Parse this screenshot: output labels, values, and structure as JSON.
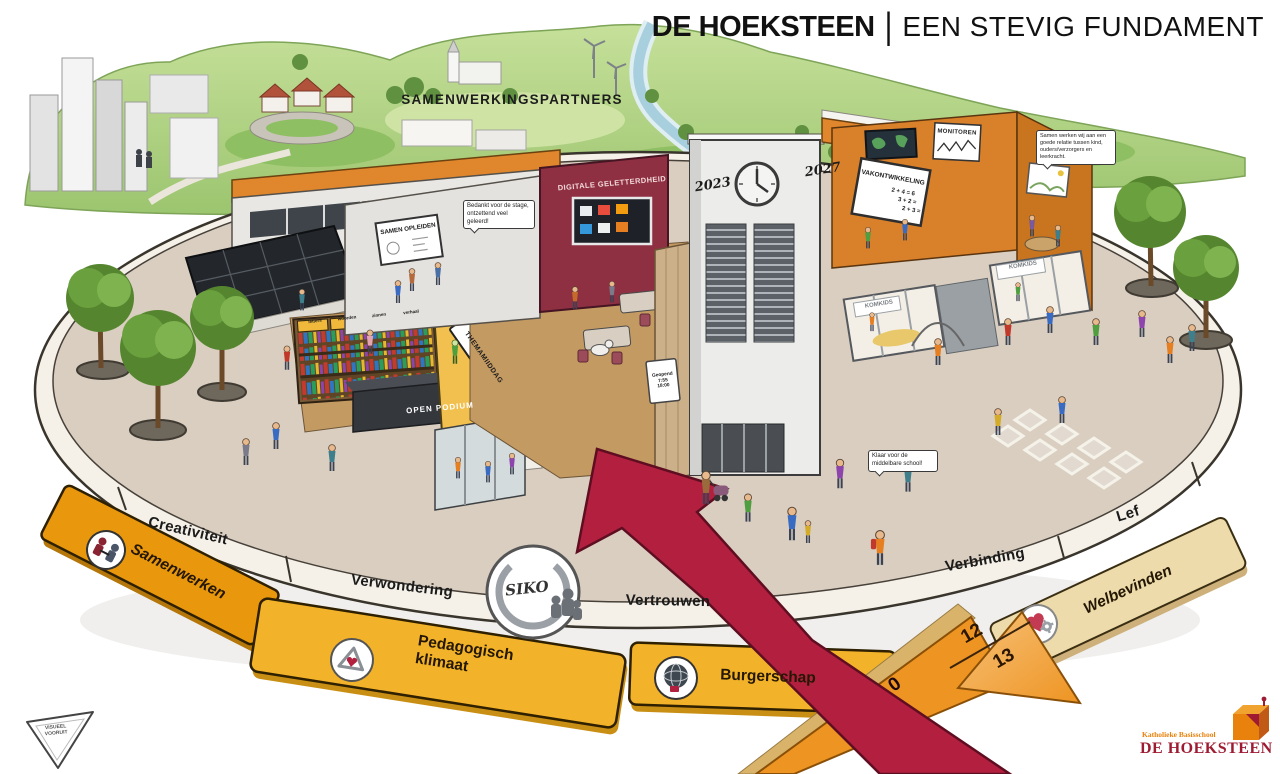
{
  "header": {
    "brand": "DE HOEKSTEEN",
    "separator": "|",
    "subtitle": "EEN STEVIG FUNDAMENT"
  },
  "landscape": {
    "partners_label": "SAMENWERKINGSPARTNERS"
  },
  "timeline": {
    "start_year": "2023",
    "end_year": "2027"
  },
  "school": {
    "digital_wall_banner": "DIGITALE GELETTERDHEID",
    "samen_opleiden_board": "SAMEN OPLEIDEN",
    "monitoren_poster": "MONITOREN",
    "vakontwikkeling_board": "VAKONTWIKKELING",
    "board_sums": [
      "2 + 4 = 6",
      "3 + 2 =",
      "2 + 3 ="
    ],
    "themamiddag_banner": "THEMAMIIDDAG",
    "open_podium_stage": "OPEN PODIUM",
    "childcare_sign_left": "KOMKIDS",
    "childcare_sign_right": "KOMKIDS",
    "bookshelf_labels": [
      "letters",
      "woorden",
      "zinnen",
      "verhaal"
    ],
    "door_sign": {
      "line1": "Geopend",
      "line2": "7:55",
      "line3": "18:00"
    }
  },
  "speech_bubbles": {
    "stage_thanks": "Bedankt voor de stage, ontzettend veel geleerd!",
    "parent_relation": "Samen werken wij aan een goede relatie tussen kind, ouders/verzorgers en leerkracht.",
    "secondary_school": "Klaar voor de middelbare school!"
  },
  "core_values": {
    "items": [
      {
        "label": "Creativiteit"
      },
      {
        "label": "Verwondering"
      },
      {
        "label": "Vertrouwen"
      },
      {
        "label": "Verbinding"
      },
      {
        "label": "Lef"
      }
    ]
  },
  "siko_badge": {
    "label": "SIKO"
  },
  "pillars": {
    "items": [
      {
        "label": "Samenwerken",
        "icon": "handshake-circle-icon"
      },
      {
        "label": "Pedagogisch klimaat",
        "icon": "triangle-heart-icon"
      },
      {
        "label": "Burgerschap",
        "icon": "globe-icon"
      },
      {
        "label": "Welbevinden",
        "icon": "heart-gear-icon"
      }
    ]
  },
  "ages": {
    "start": "0",
    "transition_top": "12",
    "transition_bottom": "13"
  },
  "footer_logos": {
    "visueel_line1": "VISUEEL",
    "visueel_line2": "VOORUIT",
    "school_type": "Katholieke Basisschool",
    "school_name": "DE HOEKSTEEN"
  },
  "colors": {
    "arrow_red": "#b3203f",
    "arrow_orange": "#ee9422",
    "ribbon_orange": "#e9980e",
    "ribbon_amber": "#f2b22a",
    "ribbon_cream": "#eedbab",
    "wall_orange": "#d9802a",
    "wall_maroon": "#8e2f42",
    "platform_tan": "#d9cec0",
    "grass_green": "#a8cf7d",
    "logo_orange": "#e8820c",
    "logo_red": "#9e1b32"
  }
}
